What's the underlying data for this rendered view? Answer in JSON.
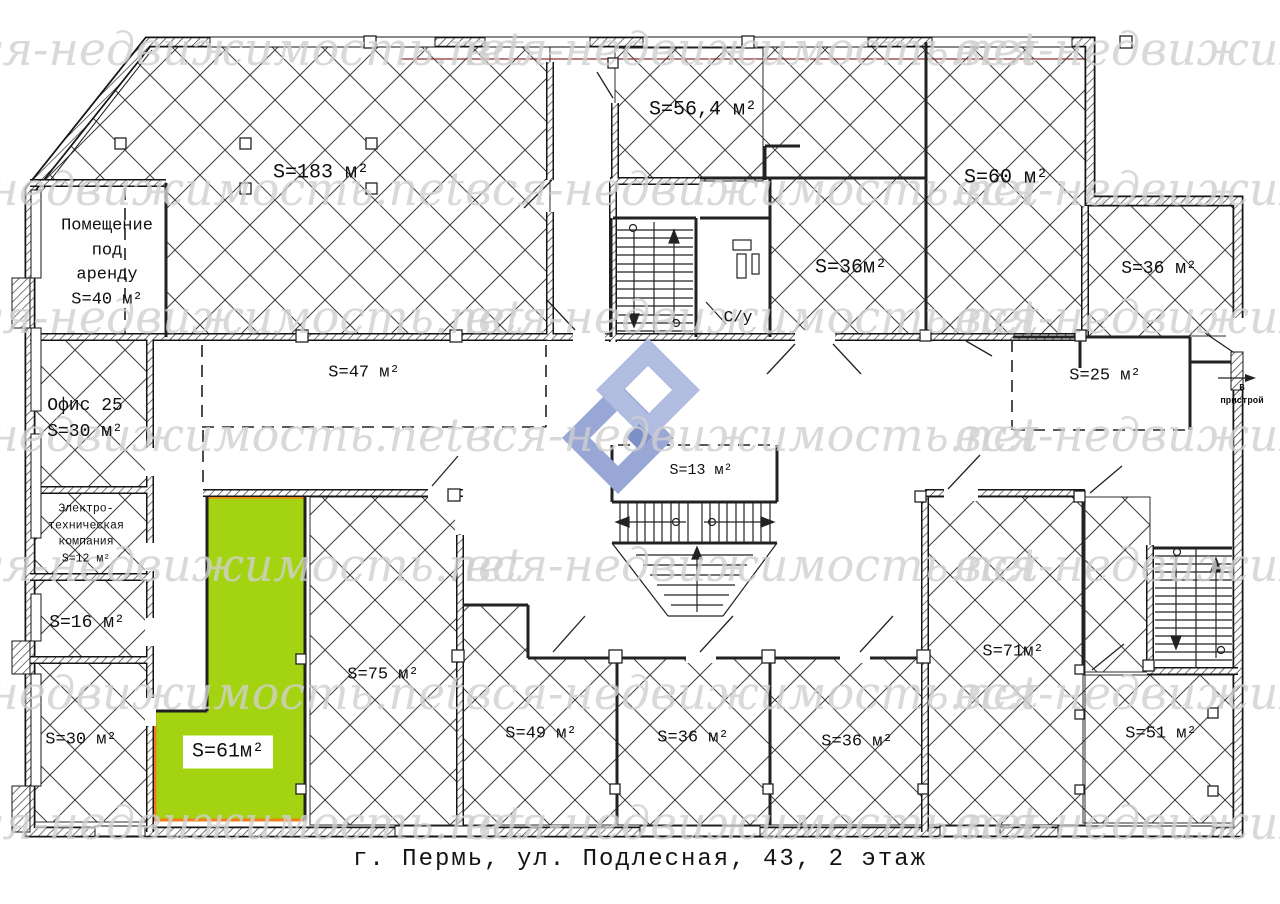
{
  "watermark": {
    "text": "вся-недвижимость.net"
  },
  "caption": {
    "text": "г. Пермь, ул. Подлесная, 43, 2 этаж"
  },
  "colors": {
    "highlight_fill": "#a4d411",
    "highlight_border": "#ef7f1a",
    "logo_light": "#b1bce1",
    "logo_mid": "#98a7d6",
    "logo_dark": "#7e90c8",
    "watermark": "#d0d0d0",
    "line": "#151515"
  },
  "rooms": {
    "rent": {
      "label": "Помещение\nпод\nаренду\nS=40 м²"
    },
    "a183": {
      "label": "S=183 м²"
    },
    "a56": {
      "label": "S=56,4 м²"
    },
    "a60": {
      "label": "S=60 м²"
    },
    "a36mid": {
      "label": "S=36м²"
    },
    "a36tr": {
      "label": "S=36 м²"
    },
    "a25": {
      "label": "S=25 м²"
    },
    "a47": {
      "label": "S=47 м²"
    },
    "office25": {
      "label": "Офис 25\nS=30 м²"
    },
    "electro": {
      "label": "Электро-\nтехническая\nкомпания\nS=12 м²"
    },
    "a16": {
      "label": "S=16 м²"
    },
    "a30": {
      "label": "S=30 м²"
    },
    "a61": {
      "label": "S=61м²"
    },
    "a75": {
      "label": "S=75 м²"
    },
    "a49": {
      "label": "S=49 м²"
    },
    "a36b1": {
      "label": "S=36 м²"
    },
    "a36b2": {
      "label": "S=36 м²"
    },
    "a71": {
      "label": "S=71м²"
    },
    "a51": {
      "label": "S=51 м²"
    },
    "a13": {
      "label": "S=13 м²"
    },
    "wc": {
      "label": "С/у"
    },
    "pristroy": {
      "label": "В пристрой"
    }
  }
}
